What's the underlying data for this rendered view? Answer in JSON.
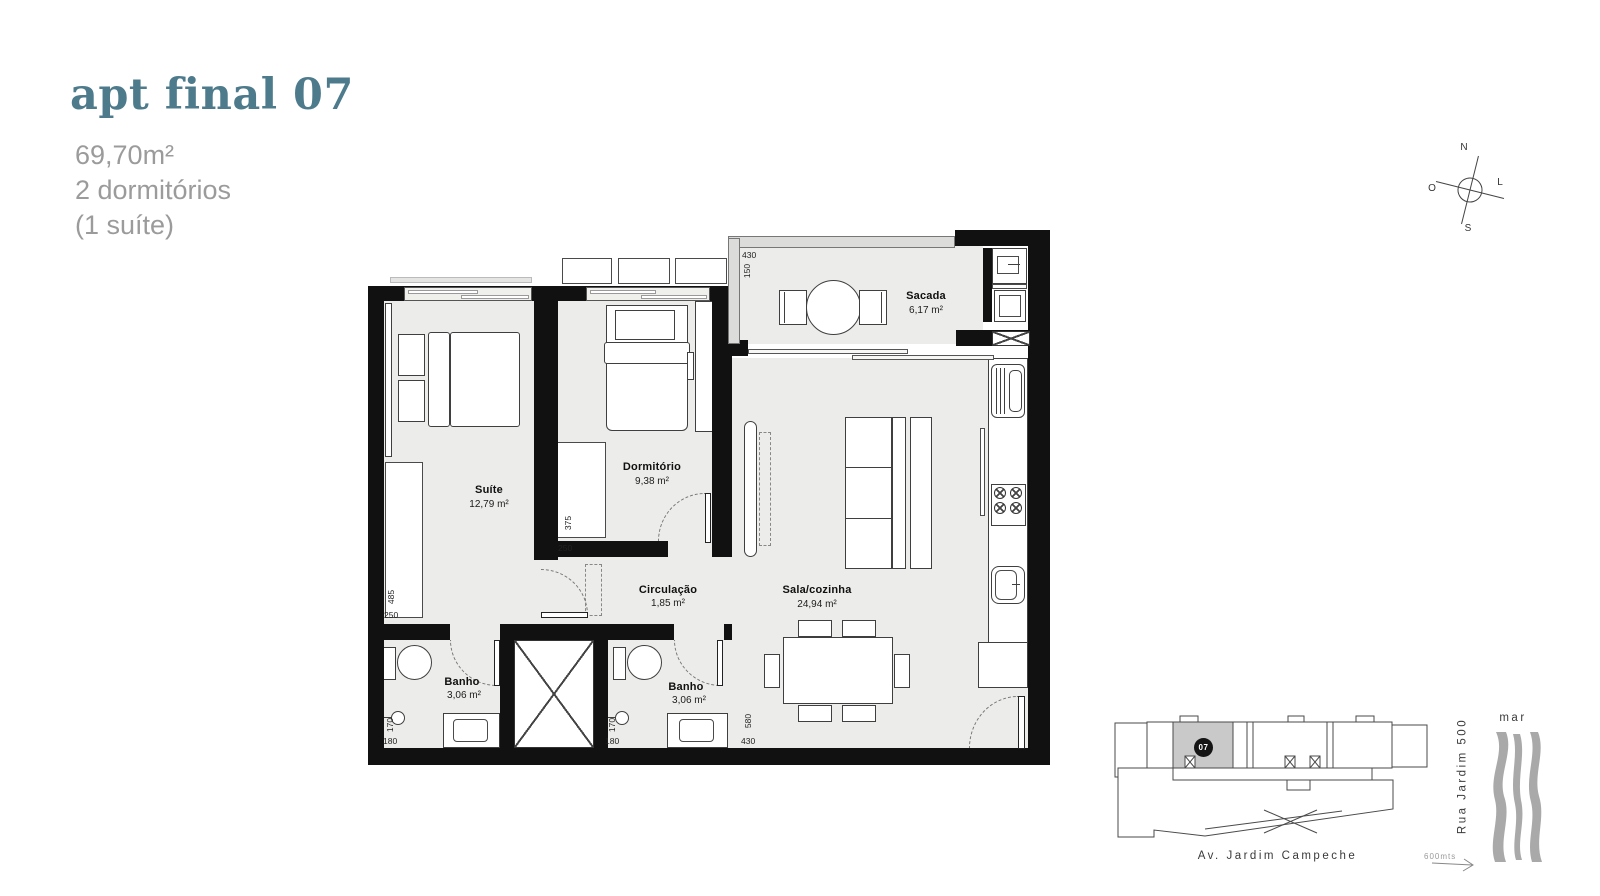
{
  "header": {
    "title": "apt final 07",
    "specs": [
      "69,70m²",
      "2 dormitórios",
      "(1 suíte)"
    ]
  },
  "compass": {
    "n": "N",
    "s": "S",
    "e": "L",
    "w": "O"
  },
  "plan": {
    "rooms": {
      "suite": {
        "name": "Suíte",
        "area": "12,79 m²"
      },
      "dormitorio": {
        "name": "Dormitório",
        "area": "9,38 m²"
      },
      "circulacao": {
        "name": "Circulação",
        "area": "1,85 m²"
      },
      "sala": {
        "name": "Sala/cozinha",
        "area": "24,94 m²"
      },
      "sacada": {
        "name": "Sacada",
        "area": "6,17 m²"
      },
      "banho_left": {
        "name": "Banho",
        "area": "3,06 m²"
      },
      "banho_right": {
        "name": "Banho",
        "area": "3,06 m²"
      }
    },
    "dims": {
      "sacada_w": "430",
      "sacada_h": "150",
      "dorm_h": "375",
      "dorm_w": "250",
      "suite_h": "485",
      "suite_w": "250",
      "banho_left_h": "170",
      "banho_left_w": "180",
      "banho_right_h": "170",
      "banho_right_w": "180",
      "sala_h": "580",
      "sala_w": "430"
    }
  },
  "sitemap": {
    "unit": "07",
    "avenue": "Av. Jardim Campeche",
    "street": "Rua Jardim 500",
    "sea": "mar",
    "distance": "600mts"
  },
  "colors": {
    "accent": "#4d7b8c",
    "muted": "#9b9b9b",
    "wall": "#111111",
    "floor": "#ececea",
    "map_gray": "#a9a9a9",
    "unit_fill": "#c9c9c9"
  }
}
